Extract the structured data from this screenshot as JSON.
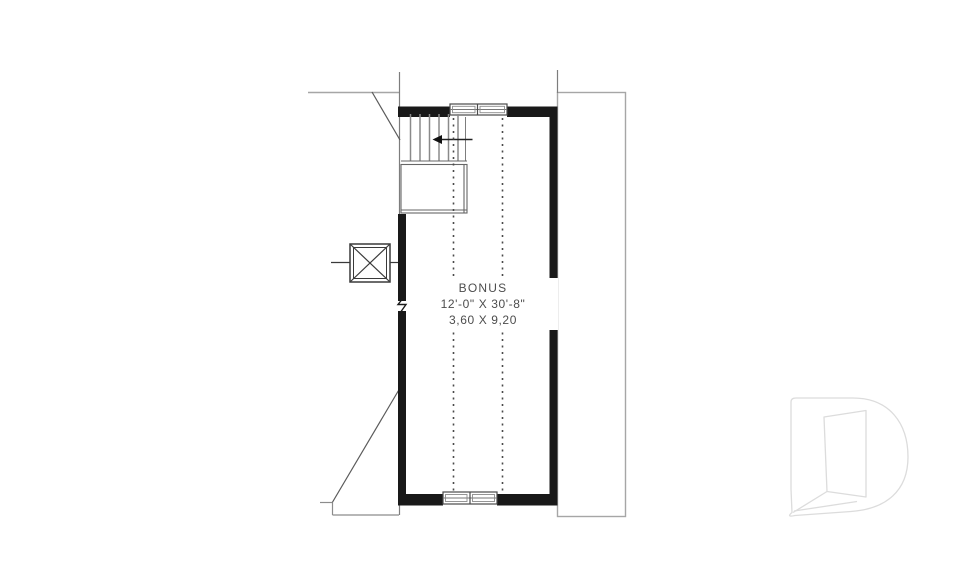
{
  "plan": {
    "room_label": "BONUS",
    "dimensions_imperial": "12'-0\" X 30'-8\"",
    "dimensions_metric": "3,60 X 9,20"
  },
  "watermark": {
    "icon": "drummond-d-logo",
    "stroke_color": "#dcdcdc"
  },
  "colors": {
    "wall": "#191919",
    "thin_line": "#8c8c8c",
    "accessory_line": "#a6a6a6",
    "text": "#4d4d4d",
    "background": "#ffffff"
  }
}
